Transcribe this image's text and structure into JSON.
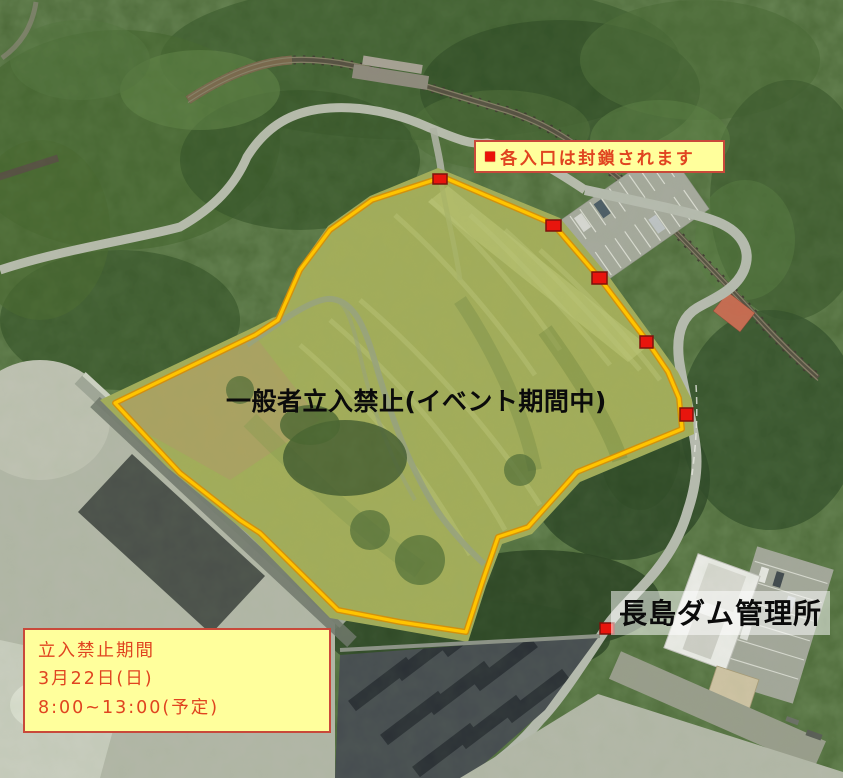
{
  "map": {
    "top_notice": {
      "bullet": "■",
      "text": "各入口は封鎖されます",
      "bg_color": "#ffff9c",
      "text_color": "#e04420"
    },
    "center_label": {
      "text": "一般者立入禁止(イベント期間中)"
    },
    "office_label": {
      "text": "長島ダム管理所"
    },
    "period_box": {
      "bg_color": "#ffff9c",
      "text_color": "#e04420",
      "lines": [
        "立入禁止期間",
        "3月22日(日)",
        "8:00~13:00(予定)"
      ]
    },
    "boundary": {
      "description": "restricted-area-outline",
      "color": "#ffc400",
      "points": "443,177 553,224 601,280 647,341 668,372 679,398 682,429 577,472 528,527 498,537 483,580 466,632 400,622 338,610 260,533 240,520 180,473 115,403 255,335 278,320 300,270 330,230 372,200"
    },
    "markers": {
      "color": "#e8150d",
      "border_color": "#7d120b",
      "items": [
        {
          "x": 433,
          "y": 174,
          "w": 14,
          "h": 10
        },
        {
          "x": 546,
          "y": 220,
          "w": 15,
          "h": 11
        },
        {
          "x": 592,
          "y": 272,
          "w": 15,
          "h": 12
        },
        {
          "x": 640,
          "y": 336,
          "w": 13,
          "h": 12
        },
        {
          "x": 680,
          "y": 408,
          "w": 13,
          "h": 13
        },
        {
          "x": 600,
          "y": 623,
          "w": 14,
          "h": 11
        }
      ]
    }
  }
}
